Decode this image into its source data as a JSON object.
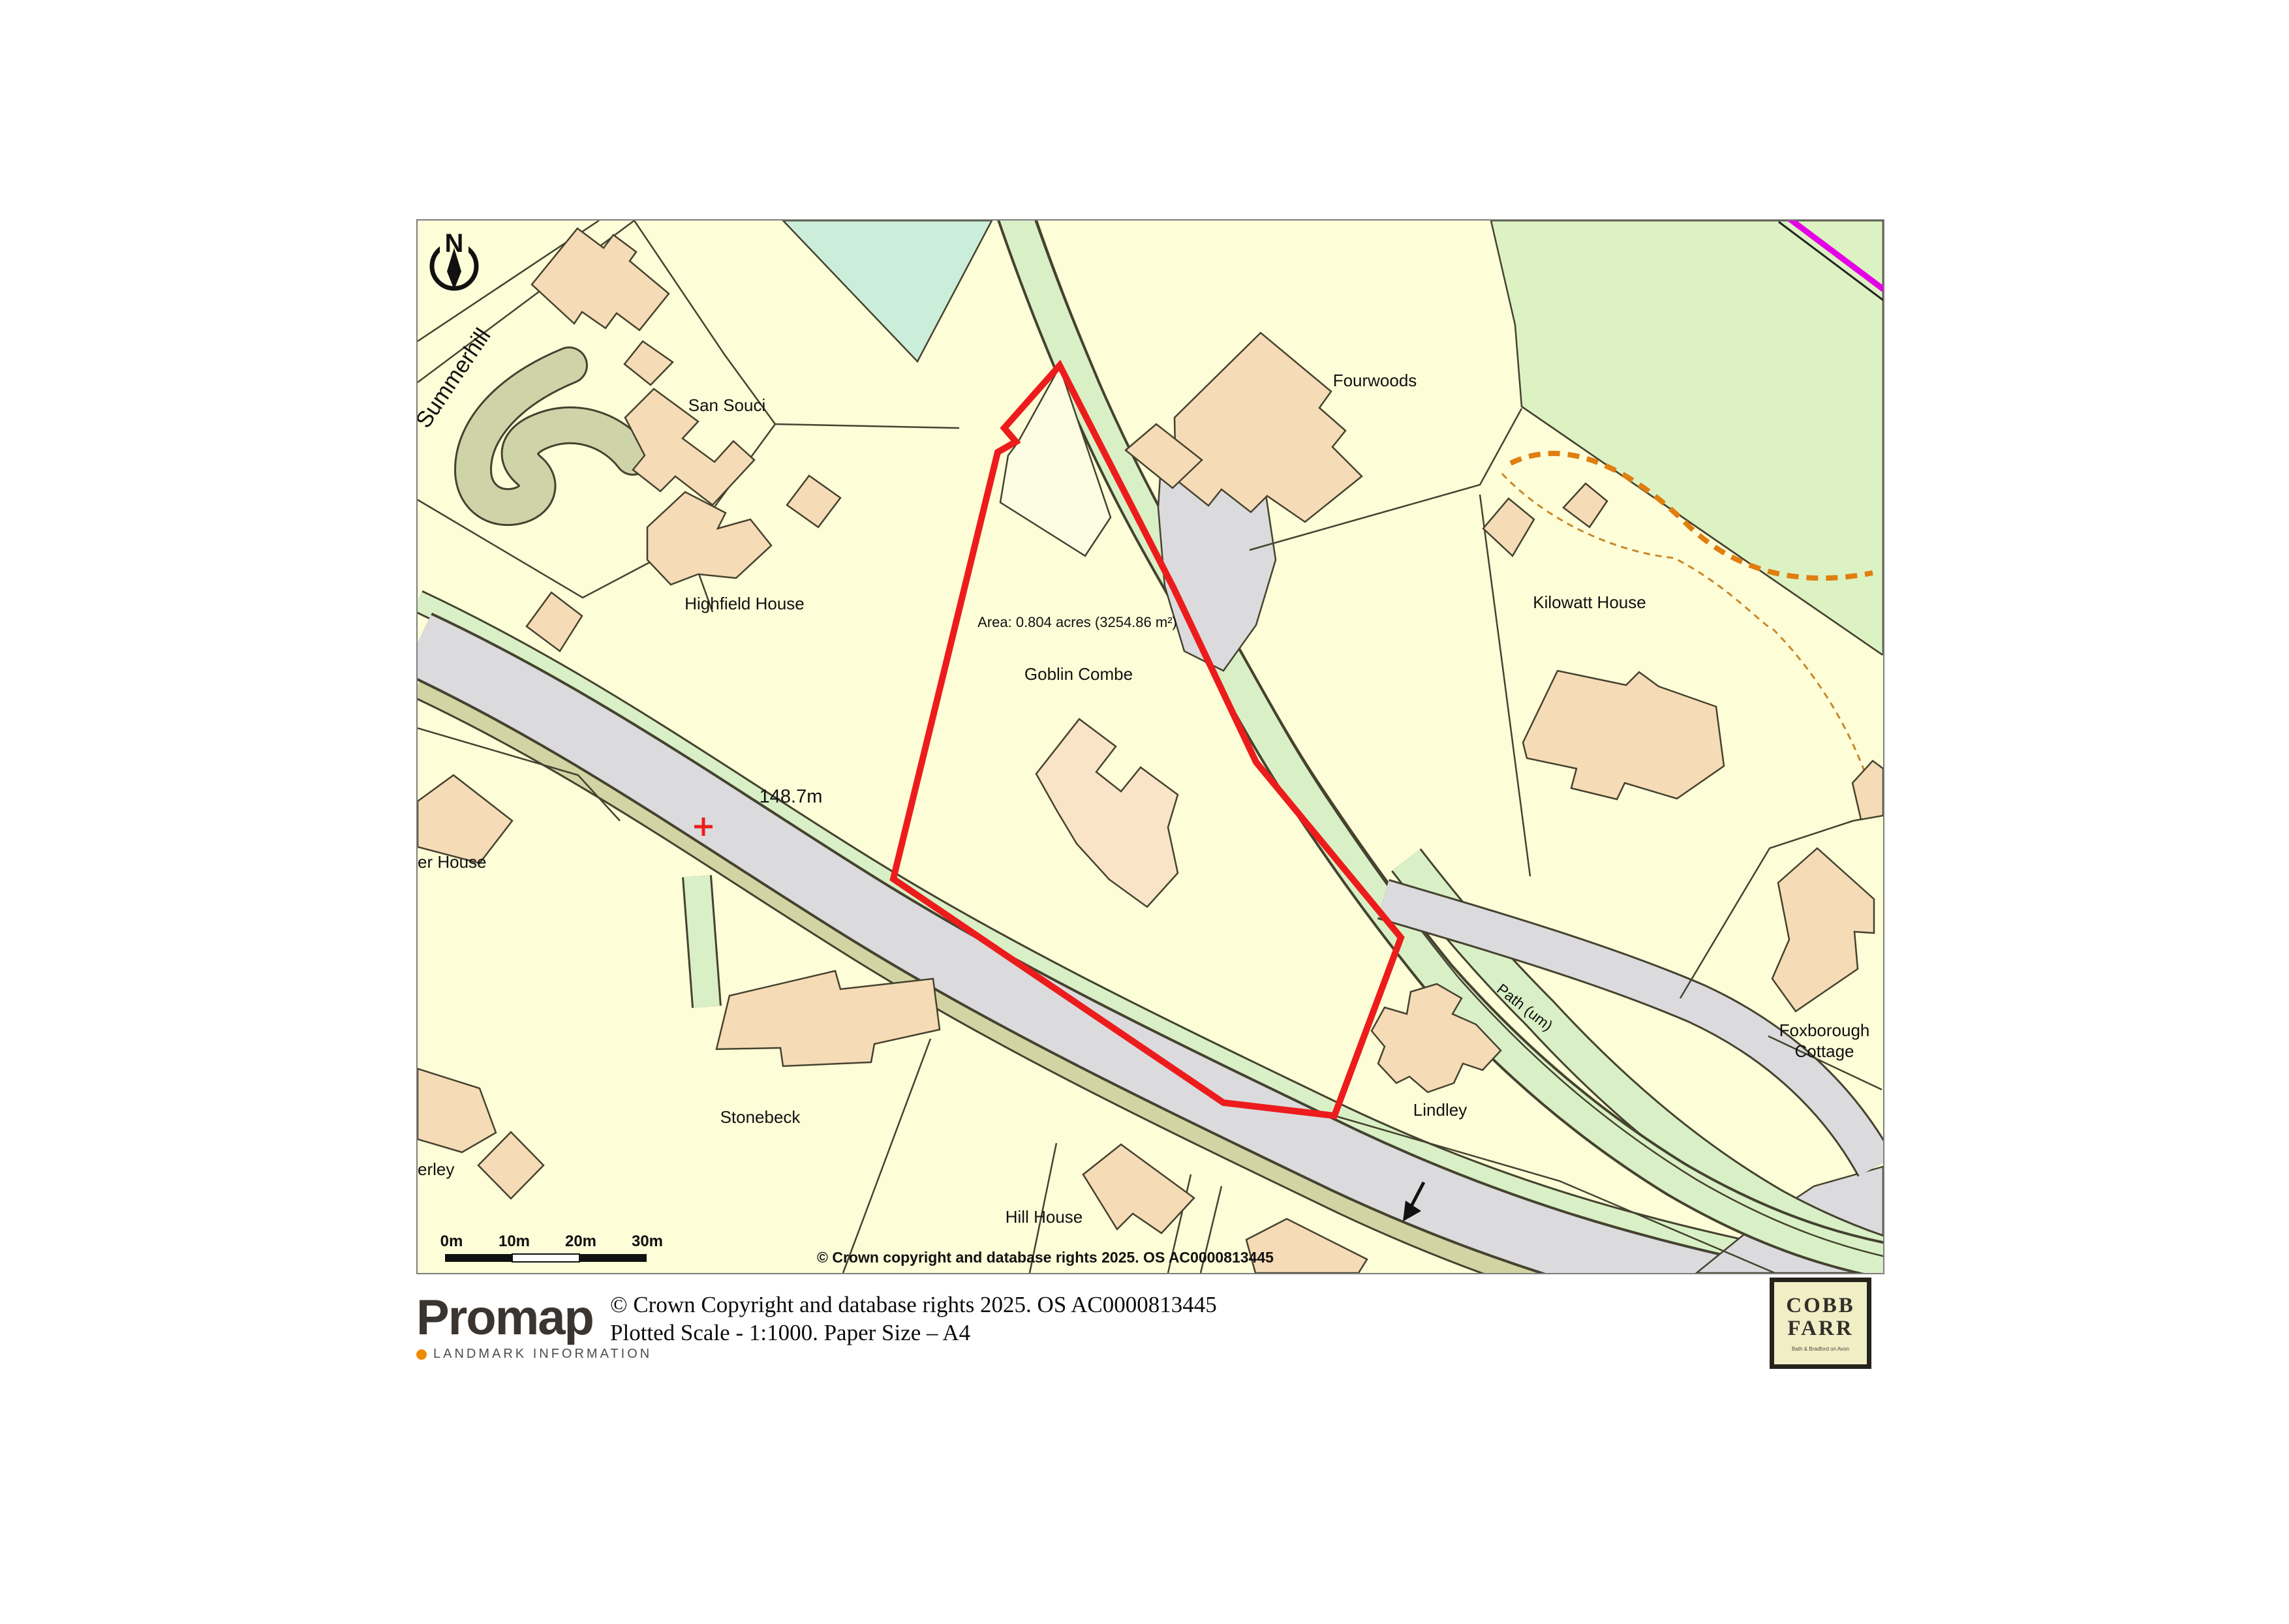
{
  "map": {
    "north_label": "N",
    "labels": {
      "summerhill": "Summerhill",
      "san_souci": "San Souci",
      "highfield_house": "Highfield House",
      "fourwoods": "Fourwoods",
      "kilowatt_house": "Kilowatt House",
      "area": "Area: 0.804 acres (3254.86 m²)",
      "goblin_combe": "Goblin Combe",
      "spot_height": "148.7m",
      "er_house": "er House",
      "foxborough_line1": "Foxborough",
      "foxborough_line2": "Cottage",
      "lindley": "Lindley",
      "stonebeck": "Stonebeck",
      "hill_house": "Hill House",
      "erley": "erley",
      "path_um": "Path (um)"
    },
    "copyright": "© Crown copyright and database rights 2025. OS AC0000813445",
    "scale_bar": {
      "t0": "0m",
      "t10": "10m",
      "t20": "20m",
      "t30": "30m"
    }
  },
  "footer": {
    "brand": "Promap",
    "brand_sub": "LANDMARK INFORMATION",
    "copyright": "© Crown Copyright and database rights 2025. OS AC0000813445",
    "scale_note": "Plotted Scale - 1:1000. Paper Size – A4"
  },
  "agency_logo": {
    "line1": "COBB",
    "line2": "FARR",
    "tagline": "Bath & Bradford on Avon"
  },
  "colors": {
    "map_background": "#FDFDD8",
    "building": "#F6DBB7",
    "building_light": "#F9E4C8",
    "road_gray": "#DBDBDE",
    "verge_green": "#D9F0C6",
    "verge_khaki": "#D2D4A4",
    "drive_olive": "#CFD3A8",
    "mint_green": "#CBEEDA",
    "woodland_green": "#DCF2C3",
    "plot_boundary_red": "#ED1C1C",
    "boundary_magenta": "#E400E4",
    "track_orange": "#E07E10",
    "map_line": "#45422F"
  }
}
